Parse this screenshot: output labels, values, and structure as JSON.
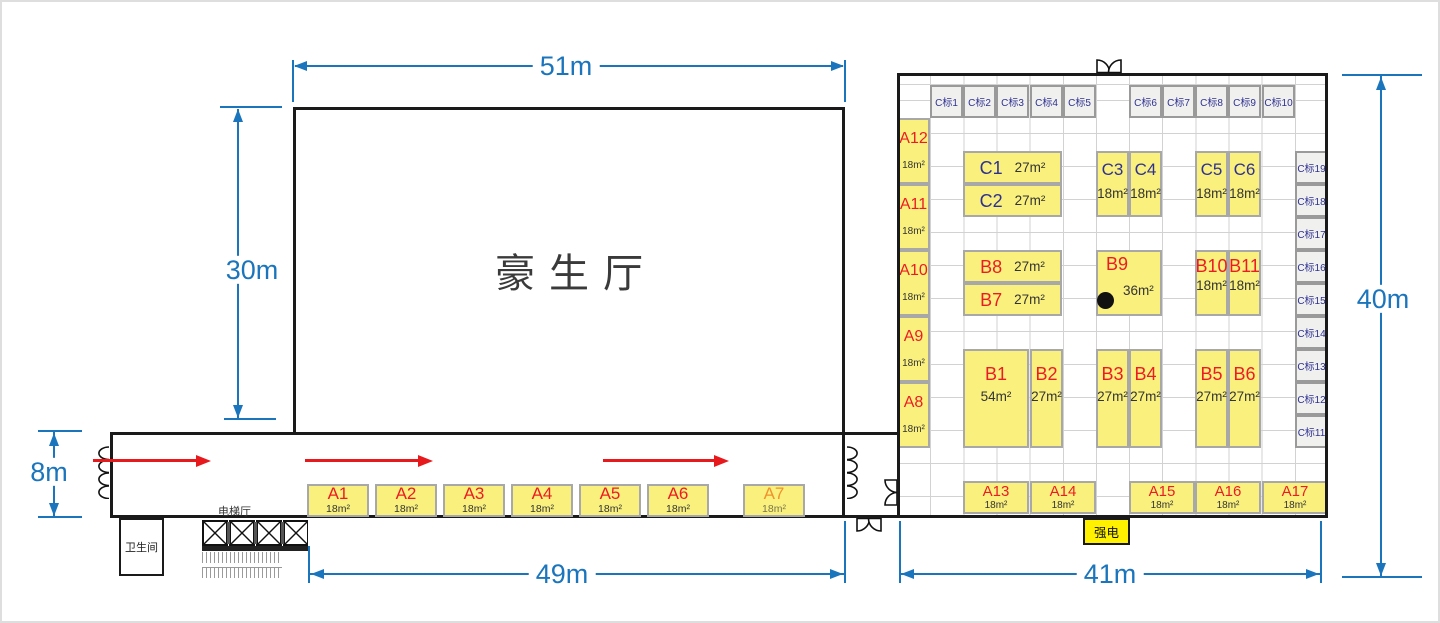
{
  "dims": {
    "w51": "51m",
    "h30": "30m",
    "h8": "8m",
    "w49": "49m",
    "w41": "41m",
    "h40": "40m"
  },
  "hall": {
    "name": "豪生厅"
  },
  "facilities": {
    "restroom": "卫生间",
    "elevator_lobby": "电梯厅",
    "power": "强电"
  },
  "corridor_booths": [
    {
      "name": "A1",
      "area": "18m²"
    },
    {
      "name": "A2",
      "area": "18m²"
    },
    {
      "name": "A3",
      "area": "18m²"
    },
    {
      "name": "A4",
      "area": "18m²"
    },
    {
      "name": "A5",
      "area": "18m²"
    },
    {
      "name": "A6",
      "area": "18m²"
    },
    {
      "name": "A7",
      "area": "18m²"
    }
  ],
  "left_booths": [
    {
      "name": "A12",
      "area": "18m²"
    },
    {
      "name": "A11",
      "area": "18m²"
    },
    {
      "name": "A10",
      "area": "18m²"
    },
    {
      "name": "A9",
      "area": "18m²"
    },
    {
      "name": "A8",
      "area": "18m²"
    }
  ],
  "c_booths": [
    {
      "name": "C1",
      "area": "27m²"
    },
    {
      "name": "C2",
      "area": "27m²"
    },
    {
      "name": "C3",
      "area": "18m²"
    },
    {
      "name": "C4",
      "area": "18m²"
    },
    {
      "name": "C5",
      "area": "18m²"
    },
    {
      "name": "C6",
      "area": "18m²"
    }
  ],
  "b_booths": [
    {
      "name": "B8",
      "area": "27m²"
    },
    {
      "name": "B7",
      "area": "27m²"
    },
    {
      "name": "B9",
      "area": "36m²"
    },
    {
      "name": "B10",
      "area": "18m²"
    },
    {
      "name": "B11",
      "area": "18m²"
    },
    {
      "name": "B1",
      "area": "54m²"
    },
    {
      "name": "B2",
      "area": "27m²"
    },
    {
      "name": "B3",
      "area": "27m²"
    },
    {
      "name": "B4",
      "area": "27m²"
    },
    {
      "name": "B5",
      "area": "27m²"
    },
    {
      "name": "B6",
      "area": "27m²"
    }
  ],
  "bottom_booths": [
    {
      "name": "A13",
      "area": "18m²"
    },
    {
      "name": "A14",
      "area": "18m²"
    },
    {
      "name": "A15",
      "area": "18m²"
    },
    {
      "name": "A16",
      "area": "18m²"
    },
    {
      "name": "A17",
      "area": "18m²"
    }
  ],
  "c_top": [
    "C标1",
    "C标2",
    "C标3",
    "C标4",
    "C标5",
    "C标6",
    "C标7",
    "C标8",
    "C标9",
    "C标10"
  ],
  "c_right": [
    "C标19",
    "C标18",
    "C标17",
    "C标16",
    "C标15",
    "C标14",
    "C标13",
    "C标12",
    "C标11"
  ],
  "colors": {
    "booth_yellow": "#FAF07E",
    "label_red": "#EC1C24",
    "label_orange": "#F0922D",
    "label_blue": "#2E3192",
    "dim_blue": "#1B75BC",
    "arrow_red": "#E8191C",
    "power_yellow": "#FFF100",
    "wall_black": "#1A1A1A"
  }
}
